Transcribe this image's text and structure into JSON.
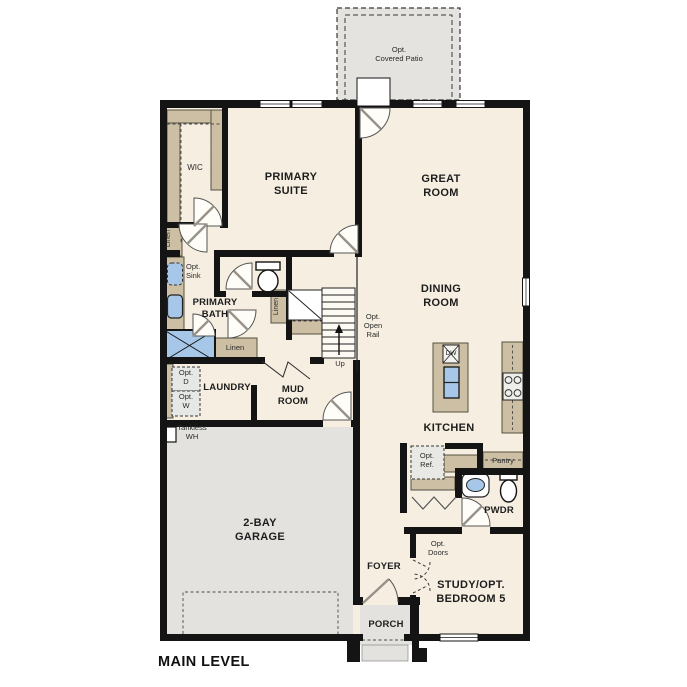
{
  "title": "MAIN LEVEL",
  "colors": {
    "wall": "#141414",
    "floor": "#f6efe1",
    "exterior": "#e3e2df",
    "cabinet": "#cdbfa3",
    "fixture_blue": "#a6c7e7"
  },
  "labels": {
    "patio": [
      "Opt.",
      "Covered Patio"
    ],
    "wic": [
      "WIC"
    ],
    "primary_suite": [
      "PRIMARY",
      "SUITE"
    ],
    "great_room": [
      "GREAT",
      "ROOM"
    ],
    "dining_room": [
      "DINING",
      "ROOM"
    ],
    "linen_left": [
      "Linen"
    ],
    "linen_stairs": [
      "Linen"
    ],
    "linen_hall": [
      "Linen"
    ],
    "opt_sink": [
      "Opt.",
      "Sink"
    ],
    "primary_bath": [
      "PRIMARY",
      "BATH"
    ],
    "opt_open_rail": [
      "Opt.",
      "Open",
      "Rail"
    ],
    "up": [
      "Up"
    ],
    "laundry": [
      "LAUNDRY"
    ],
    "mud_room": [
      "MUD",
      "ROOM"
    ],
    "opt_d": [
      "Opt.",
      "D"
    ],
    "opt_w": [
      "Opt.",
      "W"
    ],
    "tankless_wh": [
      "Tankless",
      "WH"
    ],
    "garage": [
      "2-BAY",
      "GARAGE"
    ],
    "kitchen": [
      "KITCHEN"
    ],
    "dw": [
      "DW"
    ],
    "opt_ref": [
      "Opt.",
      "Ref."
    ],
    "pantry": [
      "Pantry"
    ],
    "pwdr": [
      "PWDR"
    ],
    "foyer": [
      "FOYER"
    ],
    "opt_doors": [
      "Opt.",
      "Doors"
    ],
    "study": [
      "STUDY/OPT.",
      "BEDROOM 5"
    ],
    "porch": [
      "PORCH"
    ],
    "main_level": "MAIN LEVEL"
  }
}
